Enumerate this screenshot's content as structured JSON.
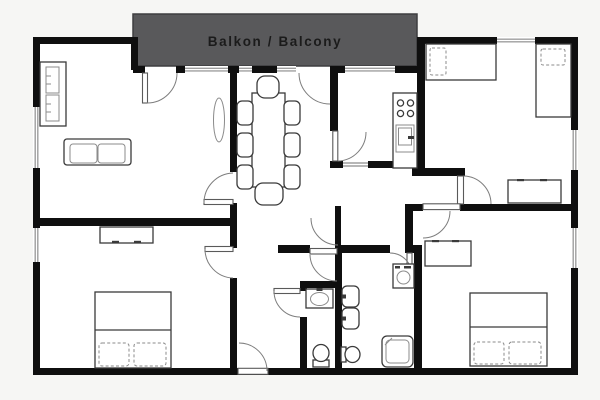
{
  "balcony": {
    "label": "Balkon / Balcony"
  },
  "colors": {
    "background": "#f6f6f4",
    "floor": "#ffffff",
    "wall": "#0f0f0f",
    "window": "#9f9f9f",
    "door": "#7d7d7d",
    "furniture": "#3a3a3a",
    "balcony_fill": "#59595b",
    "balcony_border": "#3e3e40",
    "balcony_text": "#1b1b1b"
  },
  "furniture_items": [
    "wardrobe",
    "sofa",
    "plant",
    "dining-table",
    "dining-chairs",
    "kitchen-counter",
    "stove",
    "kitchen-sink",
    "single-bed",
    "single-bed",
    "double-bed",
    "double-bed",
    "dresser",
    "dresser",
    "dresser",
    "washbasin",
    "twin-sinks",
    "toilet",
    "toilet",
    "shower",
    "washing-machine"
  ]
}
